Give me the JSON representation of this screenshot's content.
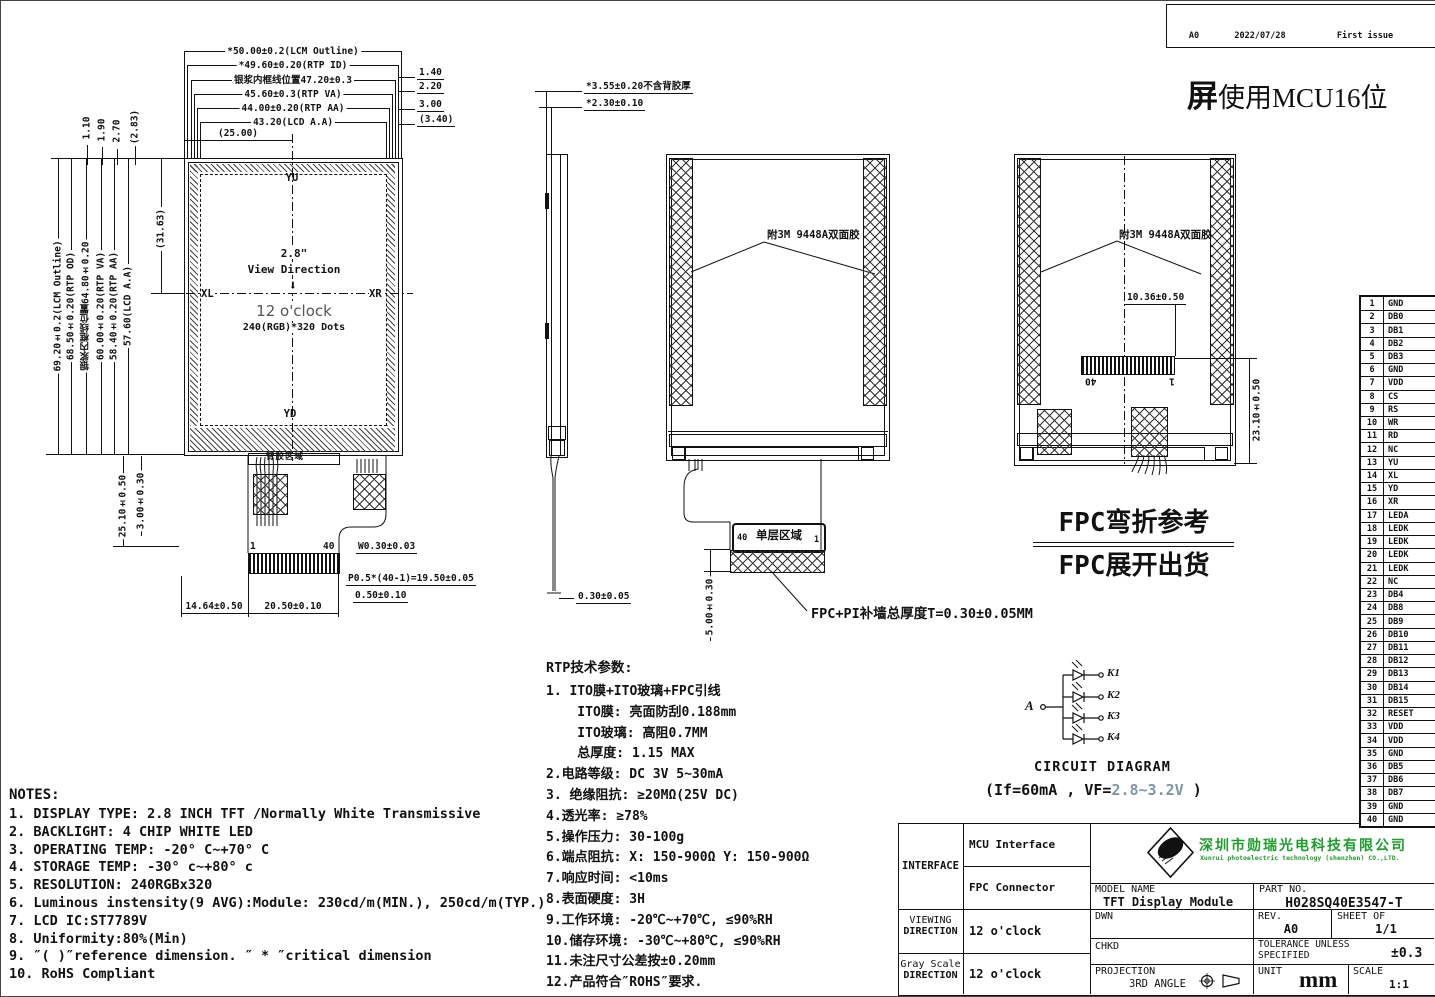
{
  "sheet": {
    "revision_table": {
      "rows": [
        {
          "rev": "",
          "date": "",
          "desc": ""
        },
        {
          "rev": "A0",
          "date": "2022/07/28",
          "desc": "First issue"
        }
      ]
    },
    "top_note_bold": "屏",
    "top_note_rest": "使用MCU16位"
  },
  "icons": {
    "view_direction_arrow": "⬇"
  },
  "colors": {
    "company_green": "#1f9d2c",
    "spec_value_color": "#7b96a4"
  },
  "front_view": {
    "dims_top": [
      "*50.00±0.2(LCM Outline)",
      "*49.60±0.20(RTP ID)",
      "银浆内框线位置47.20±0.3",
      "45.60±0.3(RTP VA)",
      "44.00±0.20(RTP AA)",
      "43.20(LCD A.A)",
      "(25.00)"
    ],
    "dims_top_right": [
      "1.40",
      "2.20",
      "3.00",
      "(3.40)"
    ],
    "dims_top_left": [
      "1.10",
      "1.90",
      "2.70",
      "(2.83)"
    ],
    "dims_left": [
      "69.20±0.2(LCM Outline)",
      "68.50±0.20(RTP OD)",
      "银浆内框线位置64.80±0.20",
      "60.00±0.20(RTP VA)",
      "58.40±0.20(RTP AA)",
      "57.60(LCD A.A)",
      "(31.63)"
    ],
    "dims_bottom_left": [
      "25.10±0.50",
      "3.00±0.30"
    ],
    "axis": {
      "top": "YU",
      "bottom": "YD",
      "left": "XL",
      "right": "XR"
    },
    "center": {
      "size": "2.8\"",
      "view_direction": "View Direction",
      "clock": "12 o'clock",
      "dots": "240(RGB)*320 Dots"
    },
    "adhesive_label": "背胶区域",
    "pin_first": "1",
    "pin_last": "40",
    "dims_bottom": [
      "W0.30±0.03",
      "P0.5*(40-1)=19.50±0.05",
      "0.50±0.10",
      "14.64±0.50",
      "20.50±0.10"
    ]
  },
  "side_view": {
    "dim_top1": "*3.55±0.20不含背胶厚",
    "dim_top2": "*2.30±0.10",
    "dim_bottom": "0.30±0.05"
  },
  "back_view_open": {
    "tape_label": "附3M 9448A双面胶",
    "pin_left": "40",
    "area_label": "单层区域",
    "pin_right": "1",
    "dim_height": "5.00±0.30",
    "note": "FPC+PI补墙总厚度T=0.30±0.05MM"
  },
  "back_view_folded": {
    "tape_label": "附3M 9448A双面胶",
    "dim_top": "10.36±0.50",
    "dim_right": "23.10±0.50",
    "pin_left": "40",
    "pin_right": "1"
  },
  "fpc_note": {
    "line1": "FPC弯折参考",
    "line2": "FPC展开出货"
  },
  "pin_table": [
    {
      "no": "1",
      "name": "GND"
    },
    {
      "no": "2",
      "name": "DB0"
    },
    {
      "no": "3",
      "name": "DB1"
    },
    {
      "no": "4",
      "name": "DB2"
    },
    {
      "no": "5",
      "name": "DB3"
    },
    {
      "no": "6",
      "name": "GND"
    },
    {
      "no": "7",
      "name": "VDD"
    },
    {
      "no": "8",
      "name": "CS"
    },
    {
      "no": "9",
      "name": "RS"
    },
    {
      "no": "10",
      "name": "WR"
    },
    {
      "no": "11",
      "name": "RD"
    },
    {
      "no": "12",
      "name": "NC"
    },
    {
      "no": "13",
      "name": "YU"
    },
    {
      "no": "14",
      "name": "XL"
    },
    {
      "no": "15",
      "name": "YD"
    },
    {
      "no": "16",
      "name": "XR"
    },
    {
      "no": "17",
      "name": "LEDA"
    },
    {
      "no": "18",
      "name": "LEDK"
    },
    {
      "no": "19",
      "name": "LEDK"
    },
    {
      "no": "20",
      "name": "LEDK"
    },
    {
      "no": "21",
      "name": "LEDK"
    },
    {
      "no": "22",
      "name": "NC"
    },
    {
      "no": "23",
      "name": "DB4"
    },
    {
      "no": "24",
      "name": "DB8"
    },
    {
      "no": "25",
      "name": "DB9"
    },
    {
      "no": "26",
      "name": "DB10"
    },
    {
      "no": "27",
      "name": "DB11"
    },
    {
      "no": "28",
      "name": "DB12"
    },
    {
      "no": "29",
      "name": "DB13"
    },
    {
      "no": "30",
      "name": "DB14"
    },
    {
      "no": "31",
      "name": "DB15"
    },
    {
      "no": "32",
      "name": "RESET"
    },
    {
      "no": "33",
      "name": "VDD"
    },
    {
      "no": "34",
      "name": "VDD"
    },
    {
      "no": "35",
      "name": "GND"
    },
    {
      "no": "36",
      "name": "DB5"
    },
    {
      "no": "37",
      "name": "DB6"
    },
    {
      "no": "38",
      "name": "DB7"
    },
    {
      "no": "39",
      "name": "GND"
    },
    {
      "no": "40",
      "name": "GND"
    }
  ],
  "rtp": {
    "title": "RTP技术参数:",
    "lines": [
      "1. ITO膜+ITO玻璃+FPC引线",
      "    ITO膜: 亮面防刮0.188mm",
      "    ITO玻璃: 高阻0.7MM",
      "    总厚度: 1.15 MAX",
      "2.电路等级: DC 3V 5~30mA",
      "3. 绝缘阻抗: ≥20MΩ(25V DC)",
      "4.透光率: ≥78%",
      "5.操作压力: 30-100g",
      "6.端点阻抗: X: 150-900Ω Y: 150-900Ω",
      "7.响应时间: <10ms",
      "8.表面硬度: 3H",
      "9.工作环境: -20℃~+70℃, ≤90%RH",
      "10.储存环境: -30℃~+80℃, ≤90%RH",
      "11.未注尺寸公差按±0.20mm",
      "12.产品符合″ROHS″要求."
    ]
  },
  "notes": {
    "title": "NOTES:",
    "lines": [
      "1. DISPLAY TYPE: 2.8 INCH TFT /Normally White Transmissive",
      "2. BACKLIGHT: 4 CHIP WHITE LED",
      "3. OPERATING TEMP: -20° C~+70° C",
      "4. STORAGE TEMP: -30° c~+80° c",
      "5. RESOLUTION: 240RGBx320",
      "6. Luminous instensity(9 AVG):Module: 230cd/m(MIN.), 250cd/m(TYP.)",
      "7. LCD IC:ST7789V",
      "8. Uniformity:80%(Min)",
      "9. ″( )″reference dimension. ″ * ″critical dimension",
      "10. RoHS Compliant"
    ]
  },
  "circuit": {
    "anode": "A",
    "cathodes": [
      "K1",
      "K2",
      "K3",
      "K4"
    ],
    "title": "CIRCUIT DIAGRAM",
    "spec_prefix": "(If=60mA , VF=",
    "spec_value": "2.8~3.2V",
    "spec_suffix": " )"
  },
  "title_block": {
    "interface_label": "INTERFACE",
    "interface_row1": "MCU Interface",
    "interface_row2": "FPC Connector",
    "viewing_label1": "VIEWING",
    "viewing_label2": "DIRECTION",
    "viewing_value": "12 o'clock",
    "gray_label1": "Gray Scale",
    "gray_label2": "DIRECTION",
    "gray_value": "12 o'clock",
    "company_cn": "深圳市勋瑞光电科技有限公司",
    "company_en": "Xunrui photoelectric technology (shenzhen) CO.,LTD.",
    "model_label": "MODEL NAME",
    "model_value": "TFT Display Module",
    "part_label": "PART NO.",
    "part_value": "H028SQ40E3547-T",
    "dwn_label": "DWN",
    "rev_label": "REV.",
    "rev_value": "A0",
    "sheet_label": "SHEET OF",
    "sheet_value": "1/1",
    "chkd_label": "CHKD",
    "tol_label1": "TOLERANCE UNLESS",
    "tol_label2": "SPECIFIED",
    "tol_value": "±0.3",
    "proj_label": "PROJECTION",
    "proj_value": "3RD ANGLE",
    "unit_label": "UNIT",
    "unit_value": "mm",
    "scale_label": "SCALE",
    "scale_value": "1:1"
  }
}
